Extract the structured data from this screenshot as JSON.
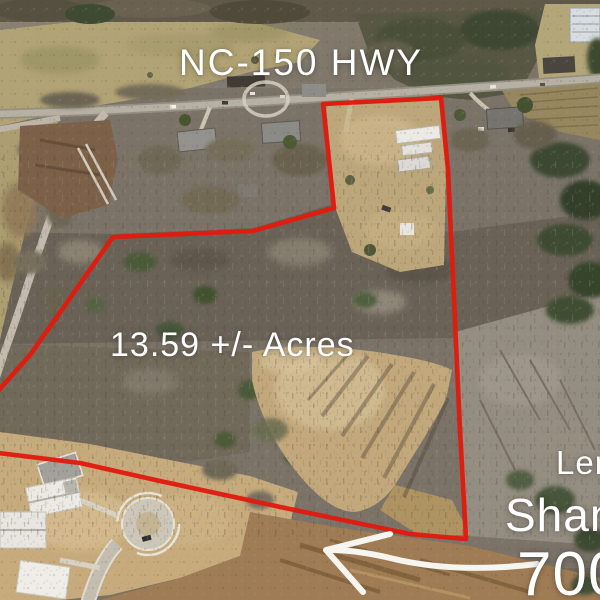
{
  "annotations": {
    "highway_label": "NC-150 HWY",
    "acreage_label": "13.59 +/- Acres",
    "side_note_line1": "Len",
    "side_note_line2": "Shannon",
    "side_note_line3": "700+"
  },
  "overlay": {
    "text_color": "#ffffff",
    "boundary_color": "#e11a0e",
    "arrow_color": "#fbfaf6",
    "boundary_points": "-10,452 80,463 160,481 285,508 410,534 466,539 460,430 454,300 448,170 441,98 323,104 329,160 334,208 253,231 113,237 30,355 -10,400",
    "arrow_tail_path": "M 537,564 C 480,571 430,568 390,558 C 365,552 345,550 329,550",
    "arrow_head_path": "M 390,534 L 326,550 L 363,592"
  }
}
